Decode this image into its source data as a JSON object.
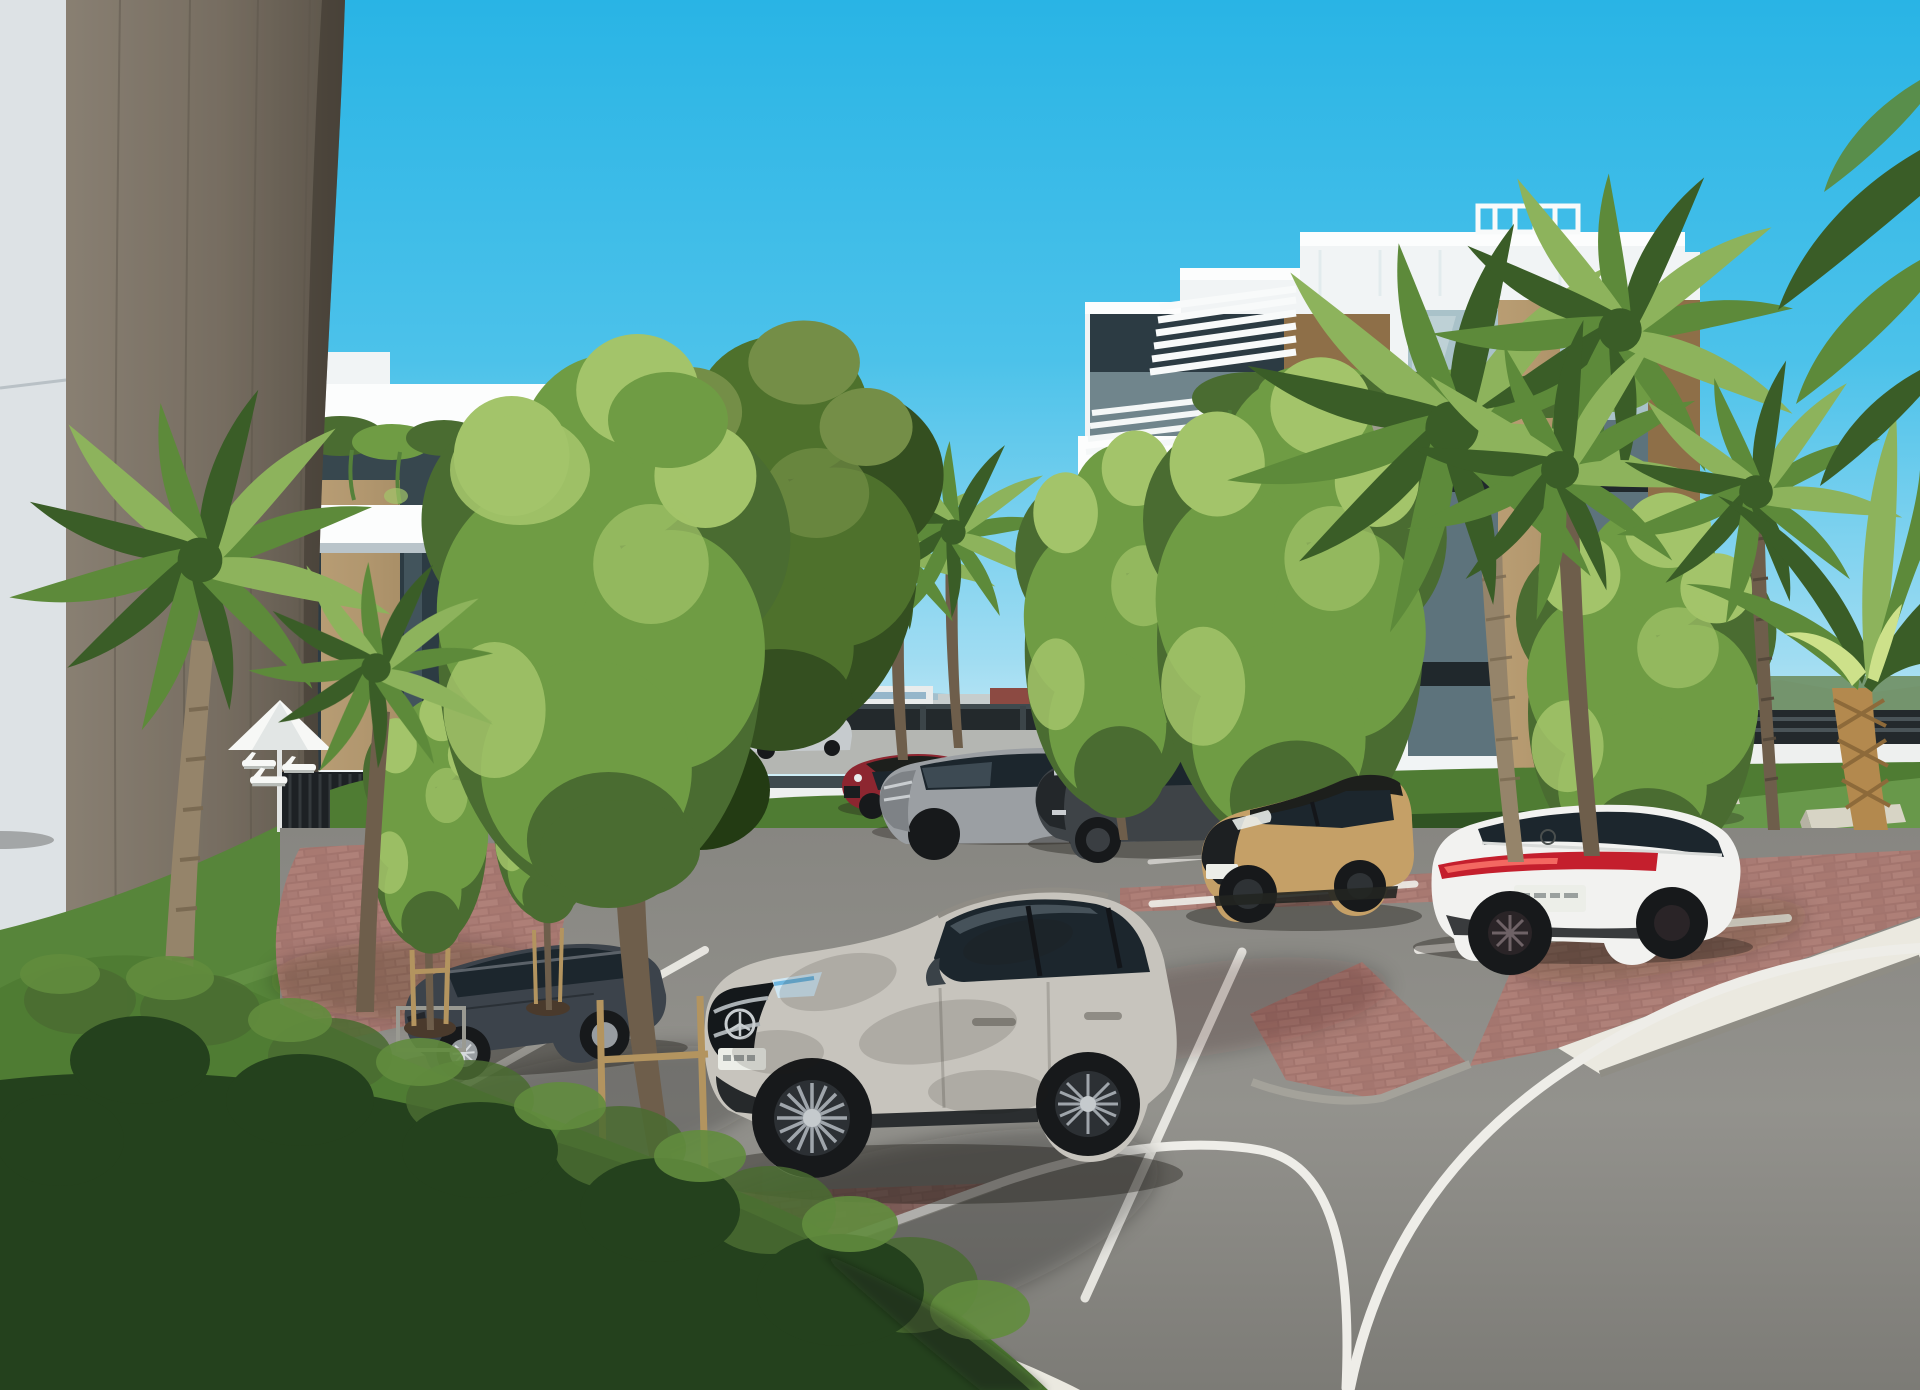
{
  "scene": {
    "type": "architectural-render",
    "description": "Sunny 3D visualization of a modern white apartment complex with roof pergolas, hanging balcony plants, palm trees, manicured hedges, a brick-paved parking area with seven parked cars and a curving asphalt road in the foreground",
    "time_of_day": "midday, clear sky",
    "objects": {
      "buildings": 3,
      "parked_cars": 7,
      "moving_cars": 1,
      "hidden_cars": 1,
      "palm_trees": 8,
      "deciduous_trees": 7,
      "benches": 2,
      "parasol": 1,
      "sun_loungers": 3
    },
    "vehicles": [
      {
        "name": "dark-sedan",
        "color_key": "sedan"
      },
      {
        "name": "silver-suv-mercedes",
        "color_key": "hero"
      },
      {
        "name": "red-compact",
        "color_key": "red"
      },
      {
        "name": "gray-suv",
        "color_key": "suv_gray"
      },
      {
        "name": "charcoal-suv",
        "color_key": "suv_dark"
      },
      {
        "name": "tan-crossover-black-roof",
        "color_key": "tan"
      },
      {
        "name": "white-liftback-mercedes",
        "color_key": "white"
      },
      {
        "name": "blue-car-behind-tree",
        "color_key": "blue"
      },
      {
        "name": "distant-driving-car",
        "color_key": "distant"
      }
    ]
  },
  "palette": {
    "sky": {
      "top": "#29b4e5",
      "mid": "#4cc2ea",
      "low": "#9fdcf2",
      "horizon": "#d9f1f7"
    },
    "distant": {
      "mountain": "#a3bfcc",
      "city_light": "#e9ecec",
      "city_mid": "#c6cdcd",
      "city_glass": "#7fa9c2",
      "city_red": "#8c4a42",
      "fence": "#23292c",
      "rail": "#3f4a4e",
      "road": "#b4b6b2",
      "wall": "#eef0ef",
      "pool": "#45bce0",
      "far_trees": "#6f8f63"
    },
    "building": {
      "white": "#f1f4f5",
      "bright": "#fcfdfd",
      "shade": "#dbe2e6",
      "under": "#b9c4ca",
      "wood": "#c0a06f",
      "wood_dark": "#8e6f48",
      "glass": "#2c3b43",
      "glass_mid": "#5d737c",
      "glass_light": "#a9c2c9",
      "rail_glass": "#cddce1",
      "panel": "#dde2e5",
      "recess": "#37474e",
      "column_hi": "#998e80",
      "column_lo": "#6a6254"
    },
    "nature": {
      "fol_hi": "#a3c46a",
      "fol_mid": "#6f9c44",
      "fol_dark": "#4a6c31",
      "fol_deep": "#32511f",
      "palm_hi": "#8db35c",
      "palm_mid": "#5d8a3a",
      "palm_dark": "#3a5d27",
      "trunk": "#95846a",
      "trunk_dark": "#6e5e4b",
      "gold": "#b3894e",
      "hedge_hi": "#4f7c33",
      "hedge_dark": "#24411d",
      "lawn": "#57853a",
      "lawn_hi": "#68984a"
    },
    "ground": {
      "asphalt": "#8e8d88",
      "asphalt_lo": "#6d6c68",
      "brick": "#ab7d76",
      "brick_lo": "#8a5f59",
      "brick_deep": "#5e4540",
      "curb": "#a5a29a",
      "gravel": "#ebe9e0",
      "line": "#eeede8",
      "shadow": "#1f1b16"
    },
    "cars": {
      "hero": "#c7c4bd",
      "hero_lo": "#8f8c85",
      "sedan": "#3c434b",
      "red": "#8d2630",
      "suv_gray": "#9b9fa3",
      "suv_dark": "#3e4347",
      "tan": "#c5a067",
      "roof_black": "#1d1f1c",
      "white": "#f2f2f0",
      "blue": "#3e6da4",
      "distant": "#c6cbce",
      "tire": "#17191b",
      "rim": "#989da1",
      "glass": "#1c262d",
      "tail": "#c41f2d",
      "plate": "#eceee8"
    },
    "misc": {
      "umbrella": "#f7f8f6",
      "bench": "#d7d4c5",
      "stake": "#b3945f",
      "soil": "#4a3a2c"
    }
  }
}
